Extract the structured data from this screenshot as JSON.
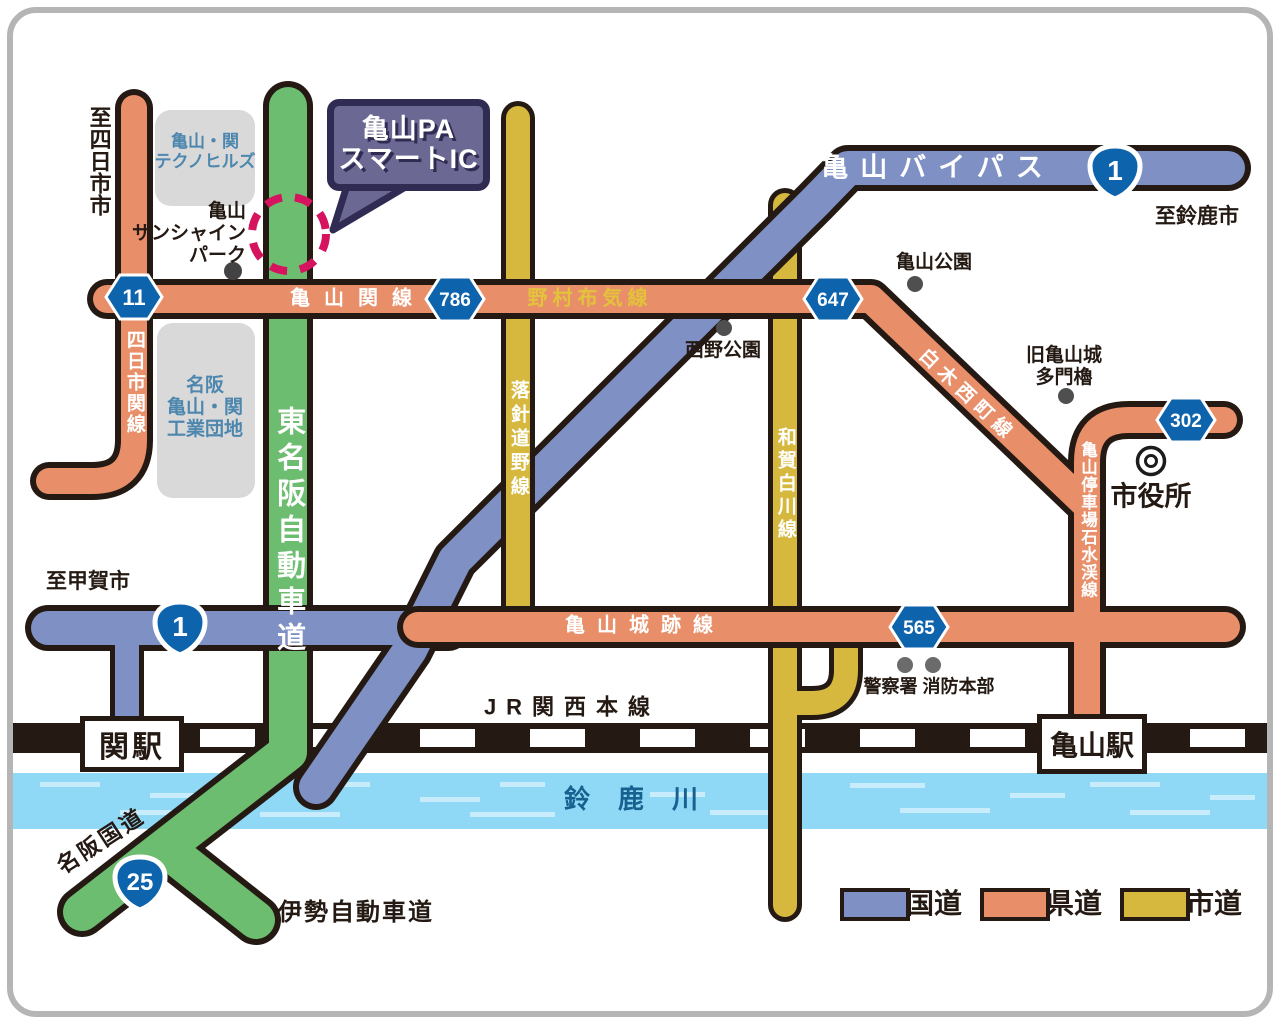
{
  "callout": {
    "line1": "亀山PA",
    "line2": "スマートIC"
  },
  "directions": {
    "yokkaichi": "至四日市市",
    "suzuka": "至鈴鹿市",
    "koga": "至甲賀市"
  },
  "roads": {
    "bypass": "亀山バイパス",
    "kameyama_seki": "亀山関線",
    "nomura_fuke": "野村布気線",
    "joseki": "亀山城跡線",
    "yokkaichi_seki": "四日市関線",
    "rakushin": "落針道野線",
    "waga": "和賀白川線",
    "shiraki": "白木西町線",
    "teishajo": "亀山停車場石水渓線",
    "higashi_meihan": "東名阪自動車道",
    "meihan": "名阪国道",
    "ise": "伊勢自動車道"
  },
  "shields": {
    "n1": "1",
    "n25": "25",
    "p11": "11",
    "p786": "786",
    "p647": "647",
    "p565": "565",
    "p302": "302"
  },
  "places": {
    "technohills1": "亀山・関",
    "technohills2": "テクノヒルズ",
    "sunshine1": "亀山",
    "sunshine2": "サンシャイン",
    "sunshine3": "パーク",
    "kogyo1": "名阪",
    "kogyo2": "亀山・関",
    "kogyo3": "工業団地",
    "kameyama_park": "亀山公園",
    "nishino_park": "西野公園",
    "castle1": "旧亀山城",
    "castle2": "多門櫓",
    "cityhall": "市役所",
    "police_fire": "警察署 消防本部"
  },
  "stations": {
    "seki": "関駅",
    "kameyama": "亀山駅"
  },
  "rail": {
    "jr": "JR関西本線"
  },
  "river": {
    "name": "鈴鹿川"
  },
  "legend": [
    {
      "label": "国道",
      "color": "#7e90c4"
    },
    {
      "label": "県道",
      "color": "#e88e69"
    },
    {
      "label": "市道",
      "color": "#d5b83d"
    }
  ],
  "colors": {
    "national_road": "#7e90c4",
    "prefectural_road": "#e88e69",
    "city_road": "#d5b83d",
    "expressway_green": "#6cbd6f",
    "outline": "#241a13",
    "shield_blue": "#0e63ad",
    "river_blue": "#8fd8f6",
    "marker_red": "#d5135e",
    "callout_purple": "#6b6893",
    "area_gray": "#d9d9da"
  }
}
